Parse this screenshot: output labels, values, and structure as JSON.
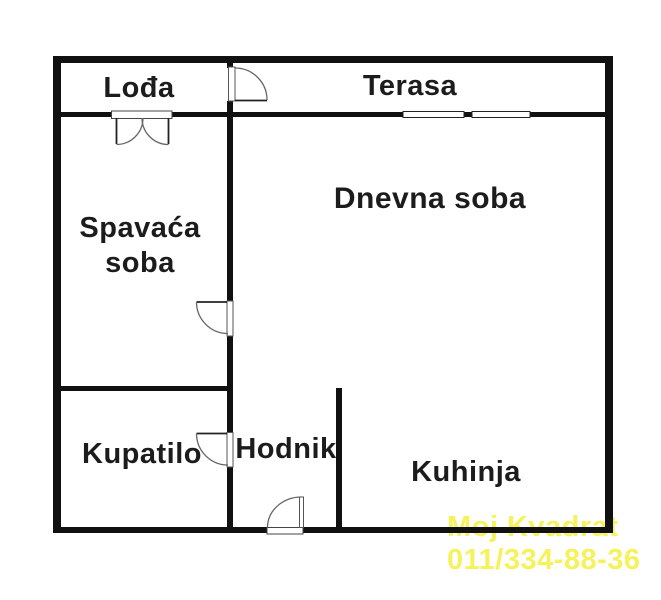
{
  "rooms": {
    "loda": "Lođa",
    "terasa": "Terasa",
    "spavaca_soba": "Spavaća soba",
    "dnevna_soba": "Dnevna soba",
    "kupatilo": "Kupatilo",
    "hodnik": "Hodnik",
    "kuhinja": "Kuhinja"
  },
  "watermark": {
    "line1": "Moj Kvadrat",
    "line2": "011/334-88-36",
    "color": "#f5f25c"
  },
  "colors": {
    "wall": "#111111",
    "background": "#ffffff"
  }
}
